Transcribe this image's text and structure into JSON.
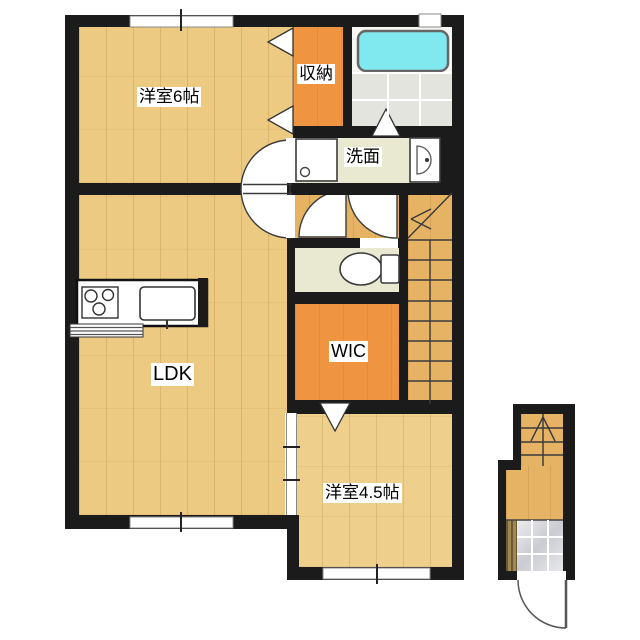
{
  "plan": {
    "type": "floor-plan",
    "rooms": {
      "bedroom6": {
        "label": "洋室6帖"
      },
      "closet": {
        "label": "収納"
      },
      "washroom": {
        "label": "洗面"
      },
      "ldk": {
        "label": "LDK"
      },
      "wic": {
        "label": "WIC"
      },
      "bedroom45": {
        "label": "洋室4.5帖"
      }
    },
    "unlabeled_areas": [
      "bathroom",
      "toilet",
      "hallway",
      "main-staircase",
      "entrance-staircase",
      "entrance-hall",
      "genkan-tile-area"
    ],
    "fixtures": [
      "bathtub",
      "washing-machine-pan",
      "washbasin",
      "toilet-bowl",
      "kitchen-stove",
      "kitchen-sink",
      "kitchen-counter",
      "shoe-cabinet",
      "entrance-door",
      "closet-folding-doors",
      "bathroom-folding-door",
      "wic-folding-door",
      "sliding-door",
      "windows",
      "door-swing-arcs",
      "stairs-direction-arrows"
    ],
    "palette": {
      "wall": "#1b1b1b",
      "wood_room": "#edca82",
      "wood_hall": "#e6b365",
      "wood_bedroom45": "#eecf8b",
      "closet_orange": "#ef9440",
      "sanitary_beige": "#e9e9d1",
      "bath_tile": "#e4e4df",
      "tub_cyan": "#7fe9ef",
      "entrance_tile": "#d9dade",
      "door_white": "#ffffff"
    }
  }
}
